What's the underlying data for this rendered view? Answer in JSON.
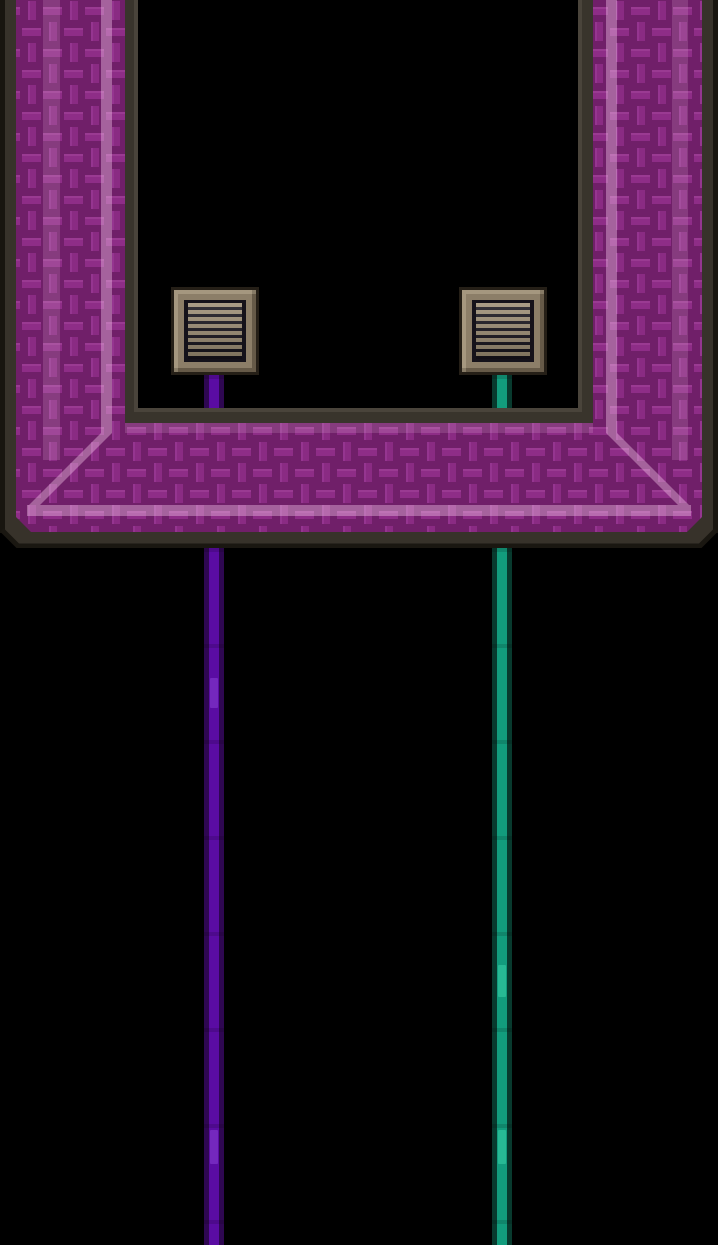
{
  "scene": {
    "description": "Pixel-art game scene: U-shaped chamber built from woven purple fabric blocks; two slatted wall vents inside with a purple wire and a green wire hanging down through the floor",
    "background_color": "#000000",
    "chamber": {
      "fabric_base_color": "#8e2d87",
      "fabric_groove_color": "#701f69",
      "fabric_highlight_color": "#f6c9ea",
      "frame_color": "#37322a",
      "frame_outline_color": "#18150f",
      "inner_bevel_color": "#4a443b"
    },
    "vents": {
      "count": 2,
      "frame_color": "#8c7e68",
      "slat_color": "#9c8d73",
      "cavity_color": "#15121a",
      "items": [
        {
          "id": "left-vent",
          "attached_wire": "purple"
        },
        {
          "id": "right-vent",
          "attached_wire": "green"
        }
      ]
    },
    "wires": {
      "purple": {
        "core_color": "#5a0ca3",
        "edge_color": "#2e0751",
        "highlight_color": "rgba(138,63,214,0.55)"
      },
      "green": {
        "core_color": "#129c7d",
        "edge_color": "#083a2e",
        "highlight_color": "rgba(59,214,171,0.50)"
      }
    }
  }
}
